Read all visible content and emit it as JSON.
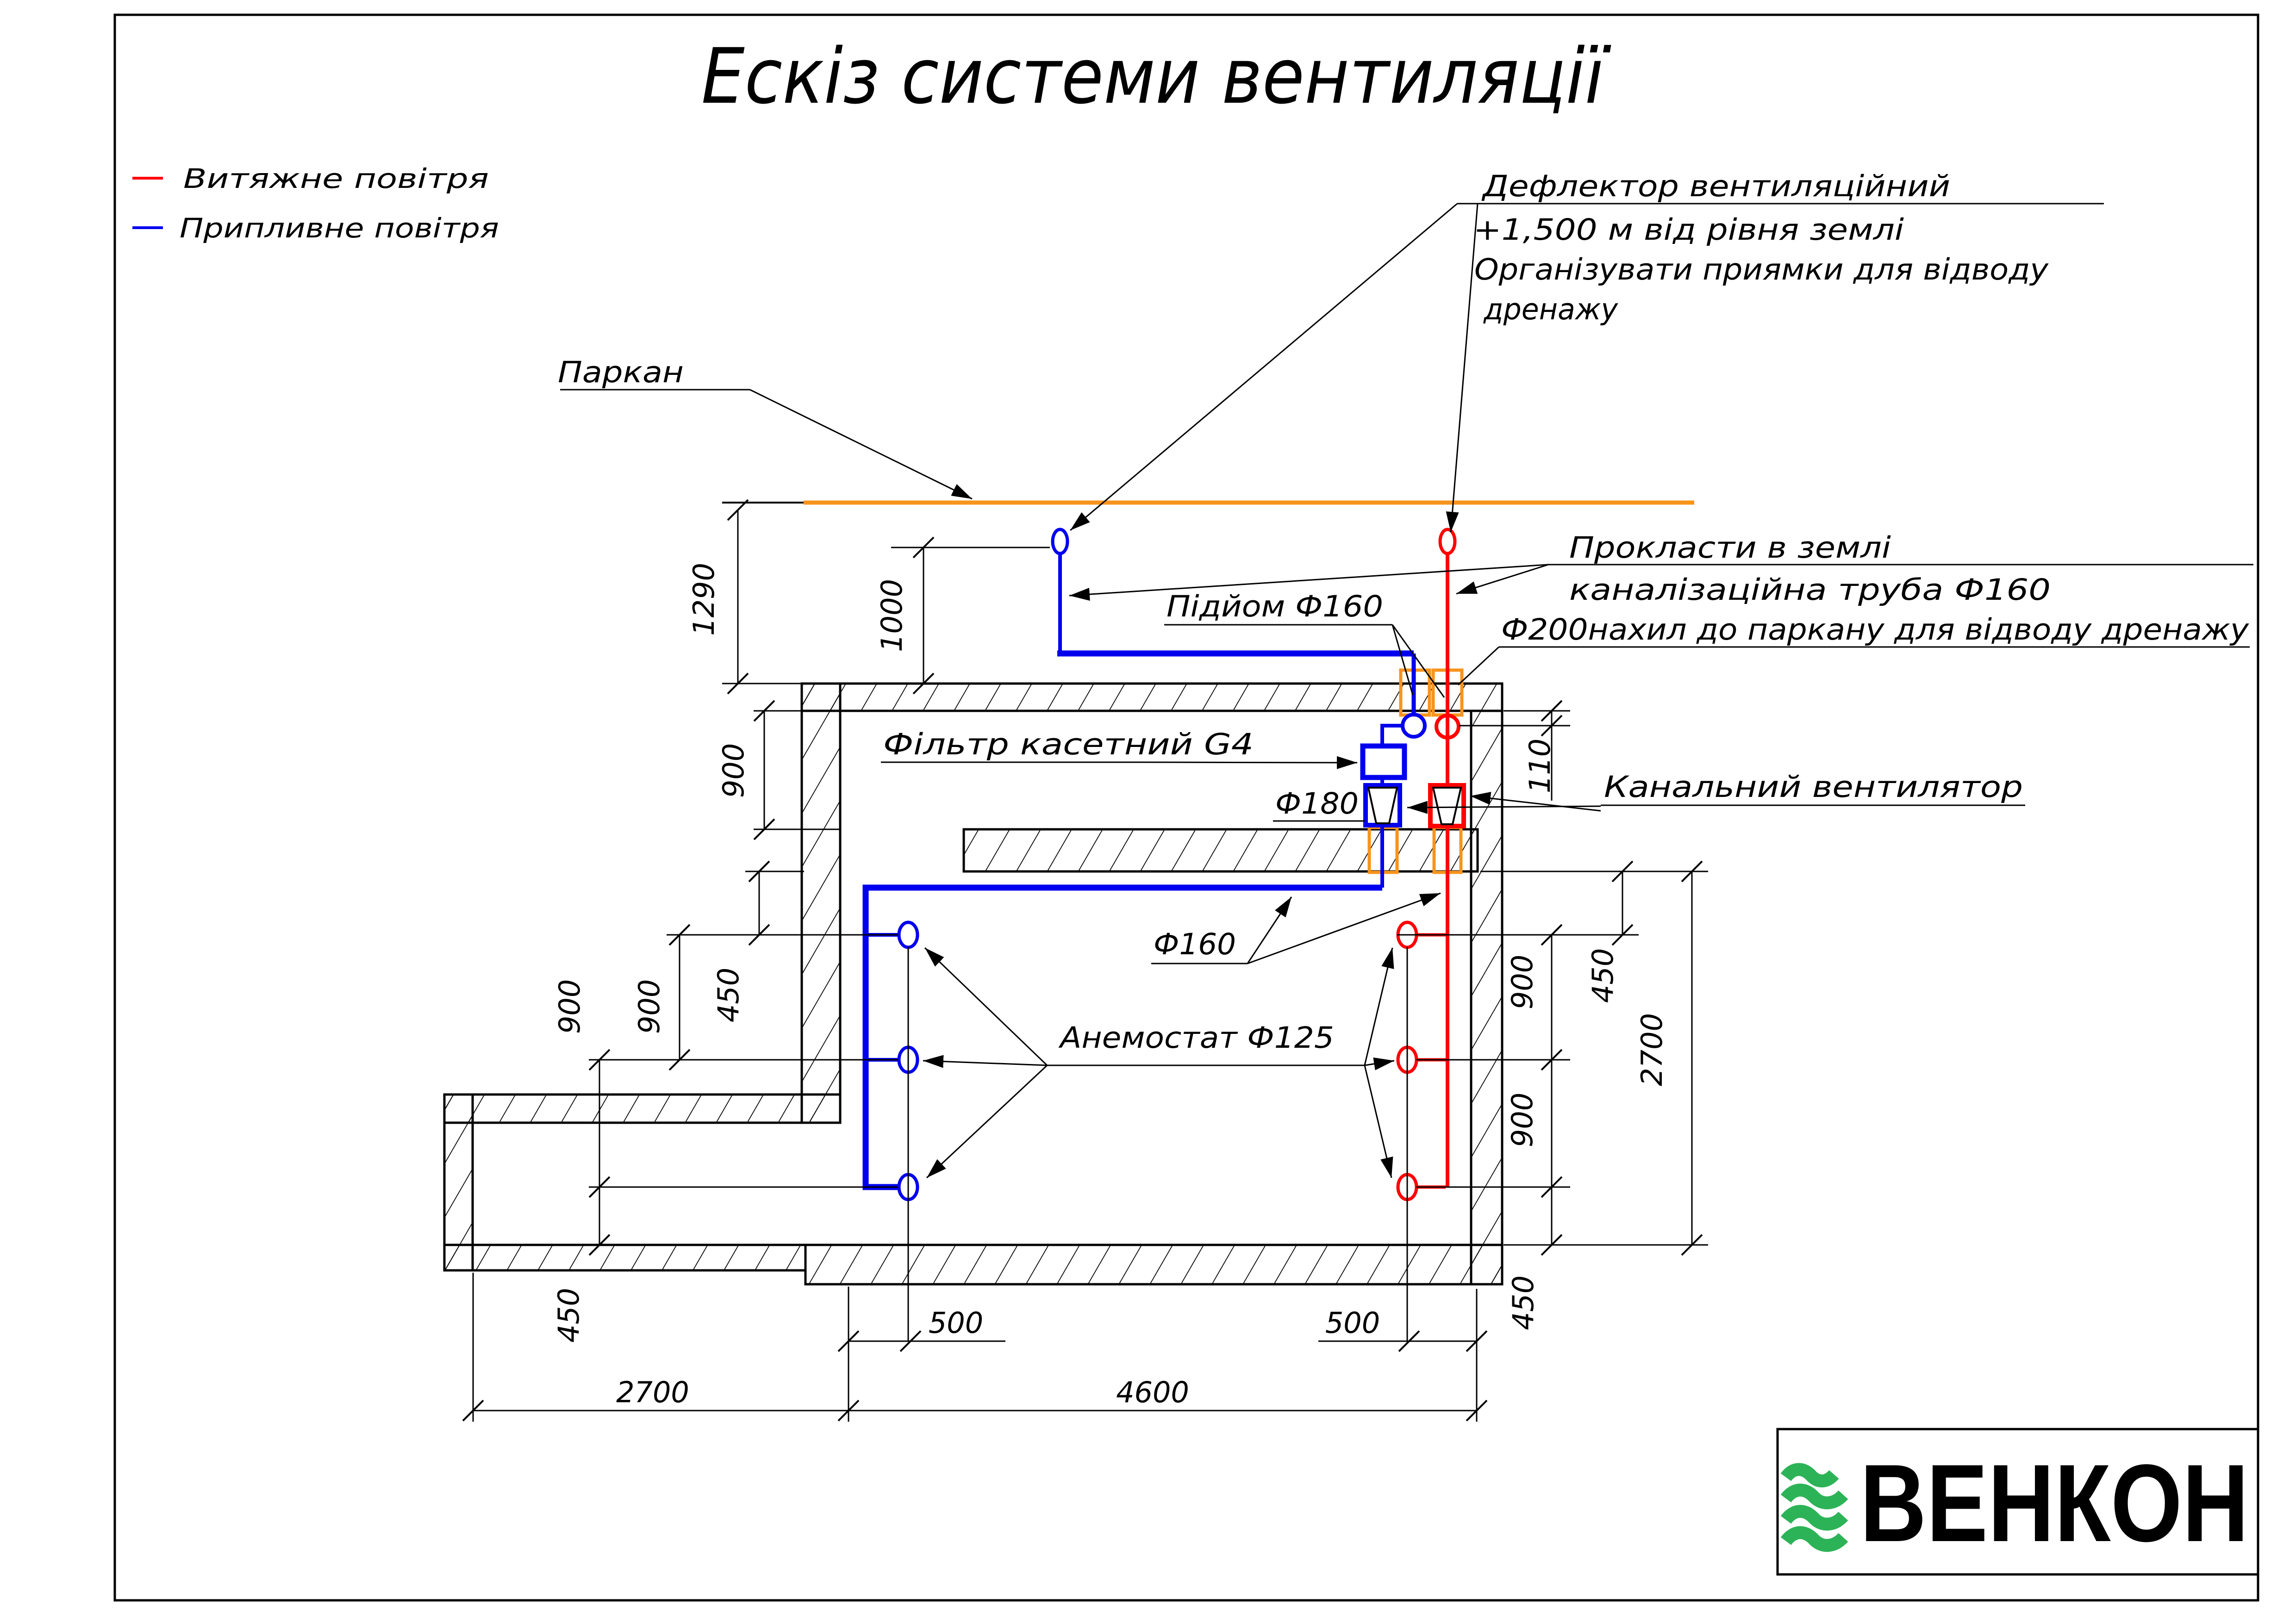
{
  "title": "Ескіз системи вентиляції",
  "legend": {
    "exhaust_label": "Витяжне повітря",
    "supply_label": "Припливне повітря"
  },
  "annotations": {
    "fence": "Паркан",
    "deflector": {
      "l1": "Дефлектор вентиляційний",
      "l2": "+1,500 м від рівня землі",
      "l3": "Організувати приямки для відводу",
      "l4": "дренажу"
    },
    "rise": "Підйом Ф160",
    "filter": "Фільтр касетний G4",
    "d180": "Ф180",
    "lay": {
      "l1": "Прокласти в землі",
      "l2": "каналізаційна труба Ф160",
      "l3": "Ф200нахил до паркану для відводу дренажу"
    },
    "duct_fan": "Канальний вентилятор",
    "d160": "Ф160",
    "anemostat": "Анемостат Ф125"
  },
  "dimensions": {
    "v1290": "1290",
    "v1000": "1000",
    "v900wall": "900",
    "v450l": "450",
    "v900l1": "900",
    "v900l2": "900",
    "v450lb": "450",
    "v2700l": "2700",
    "v500l": "500",
    "v4600": "4600",
    "v500r": "500",
    "v450rb": "450",
    "v900r1": "900",
    "v900r2": "900",
    "v450rt": "450",
    "v2700r": "2700",
    "v110": "110"
  },
  "logo": {
    "text": "ВЕНКОН"
  },
  "colors": {
    "supply": "#0000EE",
    "exhaust": "#FF0000",
    "fence": "#F7941D",
    "penetration": "#F7941D",
    "logo_green": "#2DB357",
    "logo_purple": "#443C8E"
  }
}
